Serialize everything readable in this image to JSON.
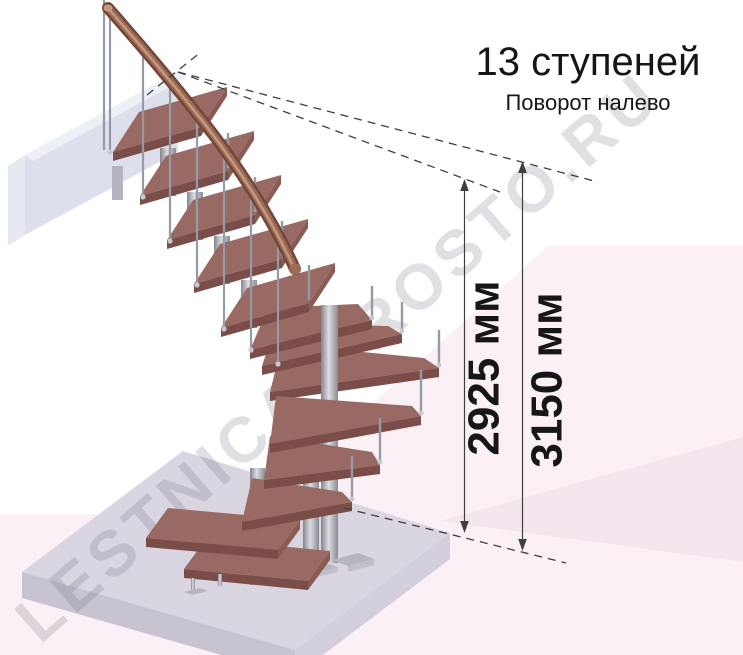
{
  "annotation": {
    "steps_label": "13 ступеней",
    "turn_label": "Поворот налево"
  },
  "dimensions": {
    "lines": [
      {
        "label": "2925 мм"
      },
      {
        "label": "3150 мм"
      }
    ]
  },
  "watermark_text": "LESTNICA-PROSTO.RU",
  "colors": {
    "background": "#ffffff",
    "text": "#161616",
    "line": "#3f3f3f",
    "backdrop_pink": "#faf0f6",
    "backdrop_pink_deep": "#f4e6ef",
    "floor_top": "#d9d5e1",
    "floor_front_left": "#c7c3d1",
    "floor_front_right": "#d2cedb",
    "wall_front": "#dde0ec",
    "wall_top": "#eef0f7",
    "wall_end": "#e7e9f2",
    "tread_top": "#996a64",
    "tread_front": "#7a4d49",
    "tread_end": "#8a5a55",
    "rail_dark": "#74463a",
    "rail_mid": "#9e6b57",
    "rail_light": "#c59b80",
    "baluster": "#959ba4",
    "metal_plate": "#b6b6c0",
    "watermark": "rgba(100,96,116,0.20)"
  }
}
